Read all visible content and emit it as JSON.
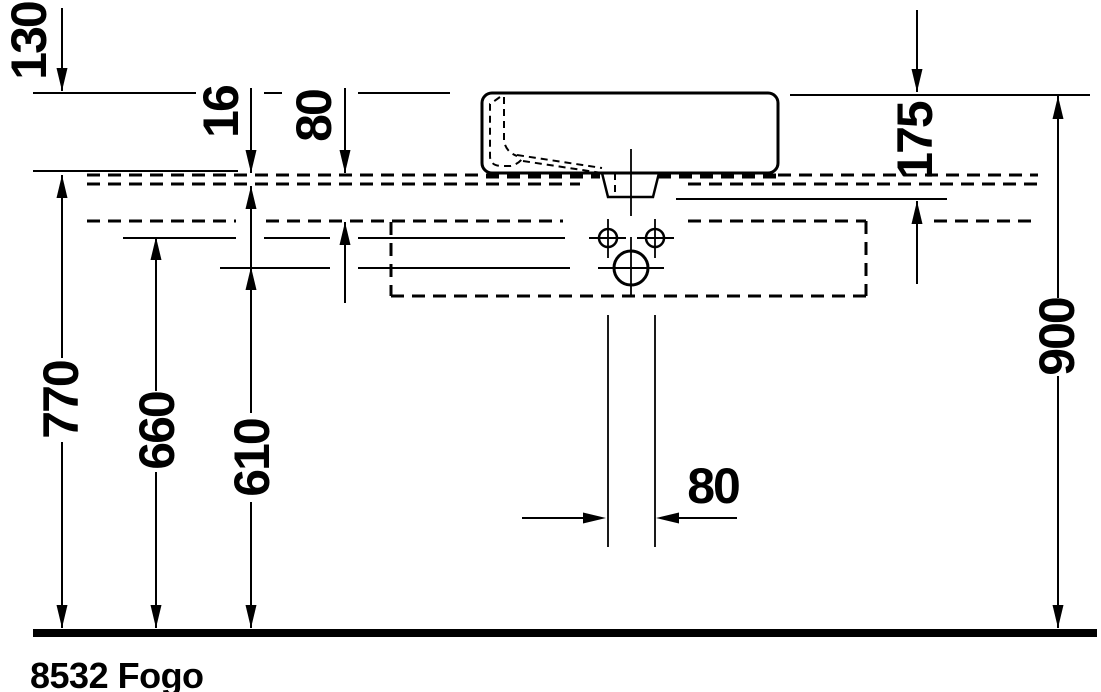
{
  "drawing": {
    "type": "technical-dimension-drawing",
    "product_code": "8532 Fogo",
    "units": "mm",
    "colors": {
      "ink": "#000000",
      "paper": "#ffffff"
    },
    "dimensions": {
      "rim_above_console": "130",
      "console_thickness": "16",
      "console_drop": "80",
      "rim_to_frame": "175",
      "console_height": "770",
      "faucet_holes_height": "660",
      "outlet_height": "610",
      "rim_height": "900",
      "holes_spacing": "80"
    }
  }
}
